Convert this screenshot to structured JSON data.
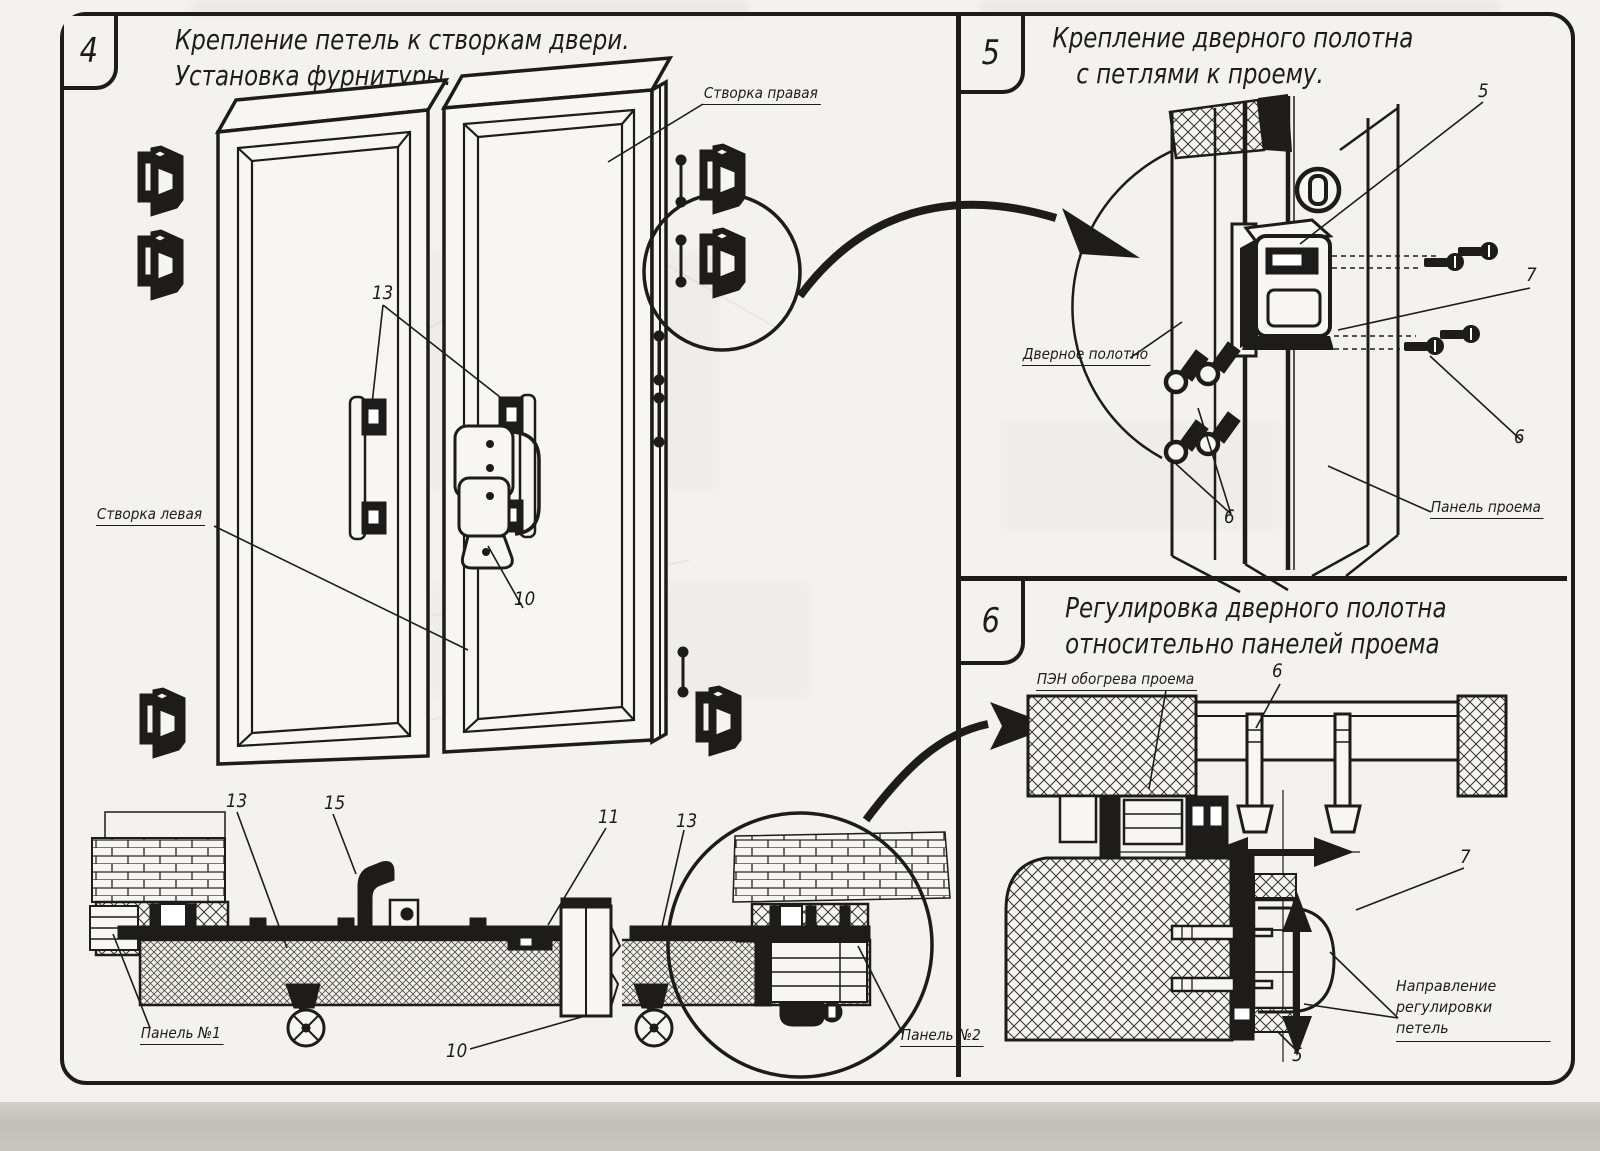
{
  "page": {
    "paper_color": "#f3f2ee",
    "ink_color": "#1d1c1a",
    "scan_strip_color": "#c6c4be"
  },
  "panel4": {
    "number": "4",
    "title_line1": "Крепление петель к створкам двери.",
    "title_line2": "Установка фурнитуры.",
    "labels": {
      "right_leaf": "Створка правая",
      "left_leaf": "Створка левая",
      "panel_1": "Панель №1",
      "panel_2": "Панель №2"
    },
    "callouts": {
      "hinge_plates": "13",
      "latch": "10",
      "section_left": "13",
      "handle": "15",
      "section_bracket": "11",
      "section_right": "13",
      "section_support": "10"
    }
  },
  "panel5": {
    "number": "5",
    "title_line1": "Крепление дверного полотна",
    "title_line2": "с петлями к проему.",
    "labels": {
      "door_leaf": "Дверное полотно",
      "opening_panel": "Панель проема"
    },
    "callouts": {
      "hinge": "5",
      "hinge_plate": "7",
      "screws_right": "6",
      "screws_left": "6"
    }
  },
  "panel6": {
    "number": "6",
    "title_line1": "Регулировка дверного полотна",
    "title_line2": "относительно панелей проема",
    "labels": {
      "opening_heater": "ПЭН обогрева проема",
      "adjust_direction_line1": "Направление регулировки",
      "adjust_direction_line2": "петель"
    },
    "callouts": {
      "bolts": "6",
      "hinge_plate": "7",
      "hinge": "5"
    }
  }
}
